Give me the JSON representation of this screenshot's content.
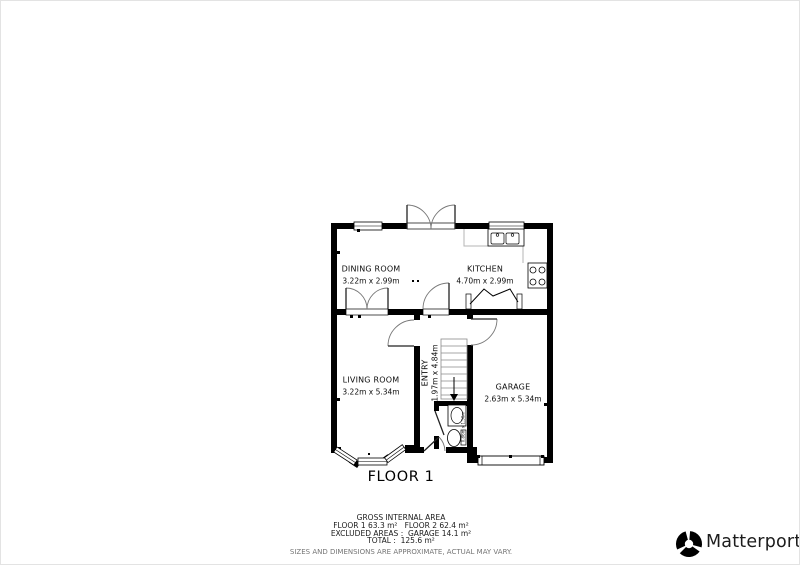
{
  "plan": {
    "floor_label": "FLOOR 1",
    "rooms": {
      "dining": {
        "name": "DINING ROOM",
        "dims": "3.22m x 2.99m"
      },
      "kitchen": {
        "name": "KITCHEN",
        "dims": "4.70m x 2.99m"
      },
      "living": {
        "name": "LIVING ROOM",
        "dims": "3.22m x 5.34m"
      },
      "entry": {
        "name": "ENTRY",
        "dims": "1.97m x 4.84m"
      },
      "garage": {
        "name": "GARAGE",
        "dims": "2.63m x 5.34m"
      },
      "wc": {
        "dims": "0.86m x 1.50m"
      }
    }
  },
  "footer": {
    "title": "GROSS INTERNAL AREA",
    "areas_line": "FLOOR 1 63.3 m²   FLOOR 2 62.4 m²",
    "excluded_line": "EXCLUDED AREAS :  GARAGE 14.1 m²",
    "total_line": "TOTAL :  125.6 m²",
    "disclaimer": "SIZES AND DIMENSIONS ARE APPROXIMATE, ACTUAL MAY VARY."
  },
  "branding": {
    "wordmark": "Matterport",
    "registered": "®"
  },
  "colors": {
    "wall": "#000000",
    "counter_line": "#b5b5b5"
  }
}
